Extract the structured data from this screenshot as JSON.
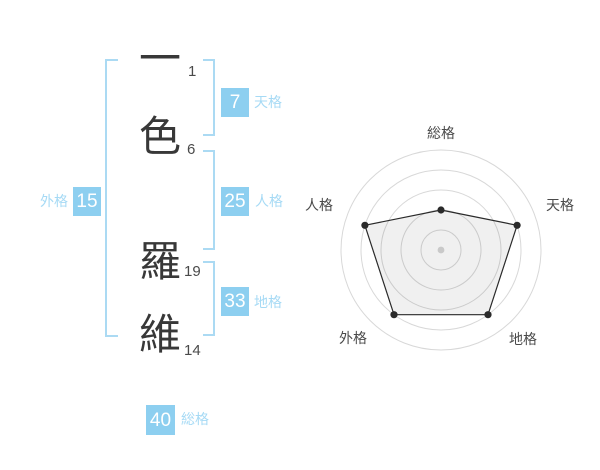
{
  "name": {
    "chars": [
      {
        "char": "一",
        "strokes": "1"
      },
      {
        "char": "色",
        "strokes": "6"
      },
      {
        "char": "羅",
        "strokes": "19"
      },
      {
        "char": "維",
        "strokes": "14"
      }
    ]
  },
  "gokaku": {
    "tenkaku": {
      "label": "天格",
      "value": "7"
    },
    "jinkaku": {
      "label": "人格",
      "value": "25"
    },
    "chikaku": {
      "label": "地格",
      "value": "33"
    },
    "gaikaku": {
      "label": "外格",
      "value": "15"
    },
    "soukaku": {
      "label": "総格",
      "value": "40"
    }
  },
  "colors": {
    "value_box": "#8dcff0",
    "value_label": "#a6daf5",
    "bracket": "#abdaf3",
    "radar_grid": "#d8d8d8",
    "radar_line": "#2a2a2a",
    "radar_fill": "rgba(0,0,0,0.06)",
    "radar_center_dot": "#c9c9c9",
    "radar_label": "#4a4a4a"
  },
  "chart_data": {
    "type": "radar",
    "categories": [
      "総格",
      "天格",
      "地格",
      "外格",
      "人格"
    ],
    "values": [
      2,
      4,
      4,
      4,
      4
    ],
    "max": 5,
    "rings": 5,
    "title": "",
    "legend": false,
    "grid": "circular"
  }
}
